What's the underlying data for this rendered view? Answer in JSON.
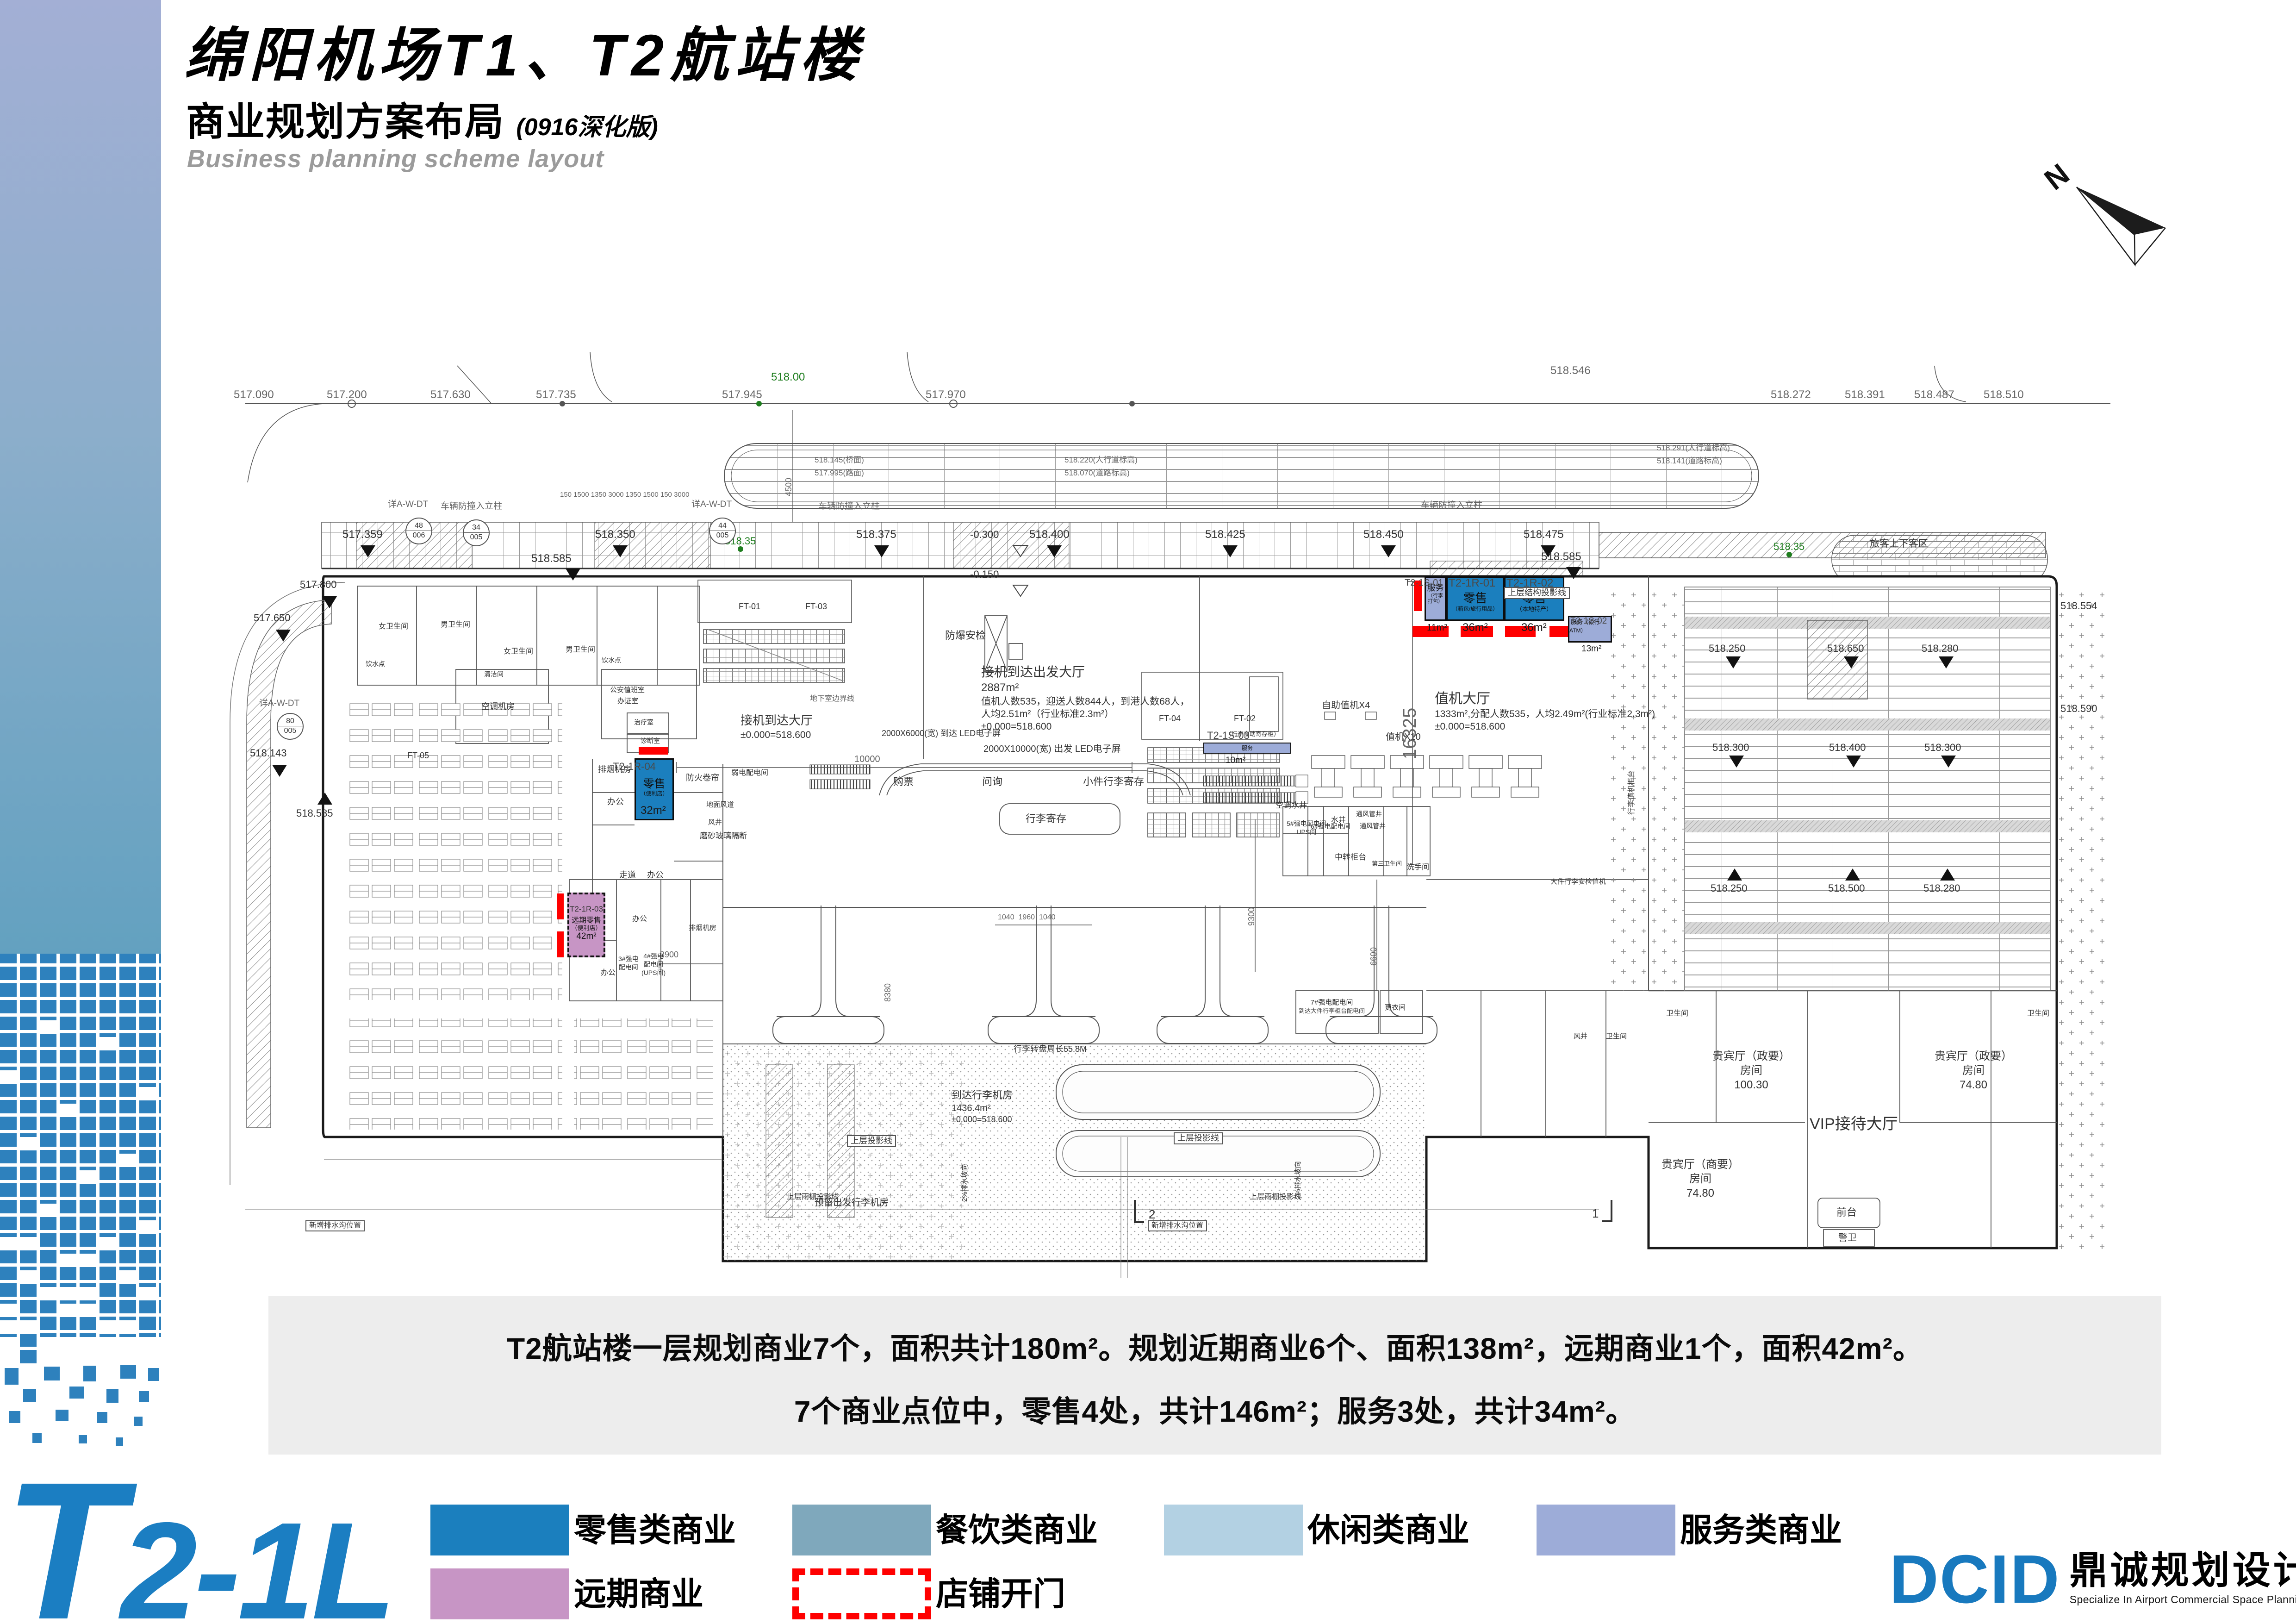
{
  "page": {
    "title_cn": "绵阳机场T1、T2航站楼",
    "subtitle_cn": "商业规划方案布局",
    "subtitle_note": "(0916深化版)",
    "subtitle_en": "Business planning scheme layout",
    "north": "N"
  },
  "summary": {
    "line1": "T2航站楼一层规划商业7个，面积共计180m²。规划近期商业6个、面积138m²，远期商业1个，面积42m²。",
    "line2": "7个商业点位中，零售4处，共计146m²；服务3处，共计34m²。"
  },
  "legend": {
    "items": [
      {
        "label": "零售类商业",
        "color": "#1B7FBE"
      },
      {
        "label": "餐饮类商业",
        "color": "#7FA8BC"
      },
      {
        "label": "休闲类商业",
        "color": "#B3D1E3"
      },
      {
        "label": "服务类商业",
        "color": "#9DACD8"
      },
      {
        "label": "远期商业",
        "color": "#C795C5"
      },
      {
        "label": "店铺开门",
        "color": "#FF0000"
      }
    ]
  },
  "footer": {
    "floor_code": "T2-1L",
    "logo_en": "DCID",
    "logo_cn": "鼎诚规划设计",
    "logo_tagline": "Specialize In Airport Commercial Space Planning And Designing"
  },
  "units": [
    {
      "id": "T2-1S-01",
      "name": "服务",
      "detail": "（行李打包）",
      "area": "11m²",
      "category": "服务类商业"
    },
    {
      "id": "T2-1R-01",
      "name": "零售",
      "detail": "（箱包/旅行用品）",
      "area": "36m²",
      "category": "零售类商业"
    },
    {
      "id": "T2-1R-02",
      "name": "零售",
      "detail": "（本地特产）",
      "area": "36m²",
      "category": "零售类商业"
    },
    {
      "id": "T2-1S-02",
      "name": "服务",
      "detail": "（银行ATM）",
      "area": "13m²",
      "category": "服务类商业"
    },
    {
      "id": "T2-1R-04",
      "name": "零售",
      "detail": "（便利店）",
      "area": "32m²",
      "category": "零售类商业"
    },
    {
      "id": "T2-1R-03",
      "name": "远期零售",
      "detail": "（便利店）",
      "area": "42m²",
      "category": "远期商业"
    },
    {
      "id": "T2-1S-03",
      "name": "服务",
      "detail": "（行李自助寄存柜）",
      "area": "10m²",
      "category": "服务类商业"
    }
  ],
  "plan": {
    "halls": {
      "checkin_1": "值机大厅",
      "checkin_2": "1333m²,分配人数535，人均2.49m²(行业标准2.3m²)",
      "arrdep_1": "接机到达出发大厅",
      "arrdep_2": "2887m²",
      "arrdep_3": "值机人数535，迎送人数844人，到港人数68人，",
      "arrdep_4": "人均2.51m²（行业标准2.3m²）",
      "arrival_1": "接机到达大厅",
      "vip_hall": "VIP接待大厅",
      "vip_room": "贵宾厅（政要）",
      "vip_room2": "贵宾厅（商要）",
      "room_word": "房间",
      "vip_area1": "100.30",
      "vip_area2": "74.80",
      "front_desk": "前台",
      "guard": "警卫",
      "baggage_1": "到达行李机房",
      "baggage_2": "1436.4m²",
      "carousel": "行李转盘周长55.8M",
      "baggage_reserved": "预留出发行李机房",
      "led_dep": "2000X10000(宽) 出发 LED电子屏",
      "led_arr": "2000X6000(宽) 到达 LED电子屏"
    },
    "rooms": {
      "wc_f": "女卫生间",
      "wc_m": "男卫生间",
      "drink": "饮水点",
      "clean": "清洁间",
      "ac": "空调机房",
      "police1": "公安值班室",
      "police2": "办证室",
      "treat": "治疗室",
      "diag": "诊断室",
      "smoke": "排烟机房",
      "office": "办公",
      "corridor": "走道",
      "weak": "弱电配电间",
      "duct": "地面风道",
      "shaft": "风井",
      "ft05": "FT-05",
      "ft01": "FT-01",
      "ft03": "FT-03",
      "ft04": "FT-04",
      "ft02": "FT-02",
      "e5a": "5#强电配电间",
      "e5b": "UPS间",
      "e6": "6#强电配电间",
      "well": "水井",
      "vent": "通风管井",
      "transfer": "中转柜台",
      "wc3": "第三卫生间",
      "wash": "洗手间",
      "e3a": "3#强电",
      "e4a": "4#强电",
      "dist": "配电间",
      "ups2": "(UPS间)",
      "e7": "7#强电配电间",
      "bag_elec": "到达大件行李柜台配电间",
      "change": "更衣间",
      "security": "防爆安检",
      "ticket": "购票",
      "info": "问询",
      "small_bag": "小件行李寄存",
      "bag_store": "行李寄存",
      "self_ck": "自助值机X4",
      "ck10": "值机X10",
      "fire": "防火卷帘",
      "glass": "磨砂玻璃隔断",
      "ac_well": "空调水井",
      "bag_counter": "行李值机柜台",
      "big_bag": "大件行李安检值机",
      "pax": "旅客上下客区",
      "proj": "上层结构投影线",
      "proj2": "上层投影线",
      "canopy_proj": "上层雨棚投影线",
      "drain": "新增排水沟位置",
      "bollard": "车辆防撞入立柱",
      "basement": "地下室边界线",
      "wc": "卫生间"
    },
    "elev": {
      "e090": "517.090",
      "e200": "517.200",
      "e630": "517.630",
      "e735": "517.735",
      "e945": "517.945",
      "e970": "517.970",
      "e272": "518.272",
      "e391": "518.391",
      "e487": "518.487",
      "e510": "518.510",
      "e546": "518.546",
      "w1a": "518.145(桥面)",
      "w1b": "517.995(路面)",
      "w2a": "518.220(人行道标高)",
      "w2b": "518.070(道路标高)",
      "w3a": "518.291(人行道标高)",
      "w3b": "518.141(道路标高)",
      "c359": "517.359",
      "c350": "518.350",
      "c585": "518.585",
      "c375": "518.375",
      "c400": "518.400",
      "c425": "518.425",
      "c450": "518.450",
      "c475": "518.475",
      "a250": "518.250",
      "a650": "518.650",
      "a280": "518.280",
      "a300": "518.300",
      "a400": "518.400",
      "a500": "518.500",
      "a554": "518.554",
      "a590": "518.590",
      "g00": "518.00",
      "g35": "518.35",
      "l650": "517.650",
      "l800": "517.800",
      "l143": "518.143",
      "l585": "518.585",
      "n300": "-0.300",
      "n150": "-0.150",
      "zero": "±0.000=518.600"
    },
    "dims": {
      "d10000": "10000",
      "d3900": "3900",
      "d9300": "9300",
      "d6600": "6600",
      "d16325": "16325",
      "d8380": "8380",
      "d4500": "4500",
      "d1040": "1040",
      "d1960": "1960",
      "row": "150 1500 1350 3000 1350 1500 150 3000"
    },
    "bubbles": {
      "ref": "详A-W-DT",
      "b1a": "48",
      "b1b": "006",
      "b2a": "34",
      "b2b": "005",
      "b3a": "44",
      "b3b": "005",
      "b4a": "80",
      "b4b": "005"
    },
    "misc": {
      "sec1": "1",
      "sec2": "2",
      "slope": "2%排水坡向"
    }
  }
}
